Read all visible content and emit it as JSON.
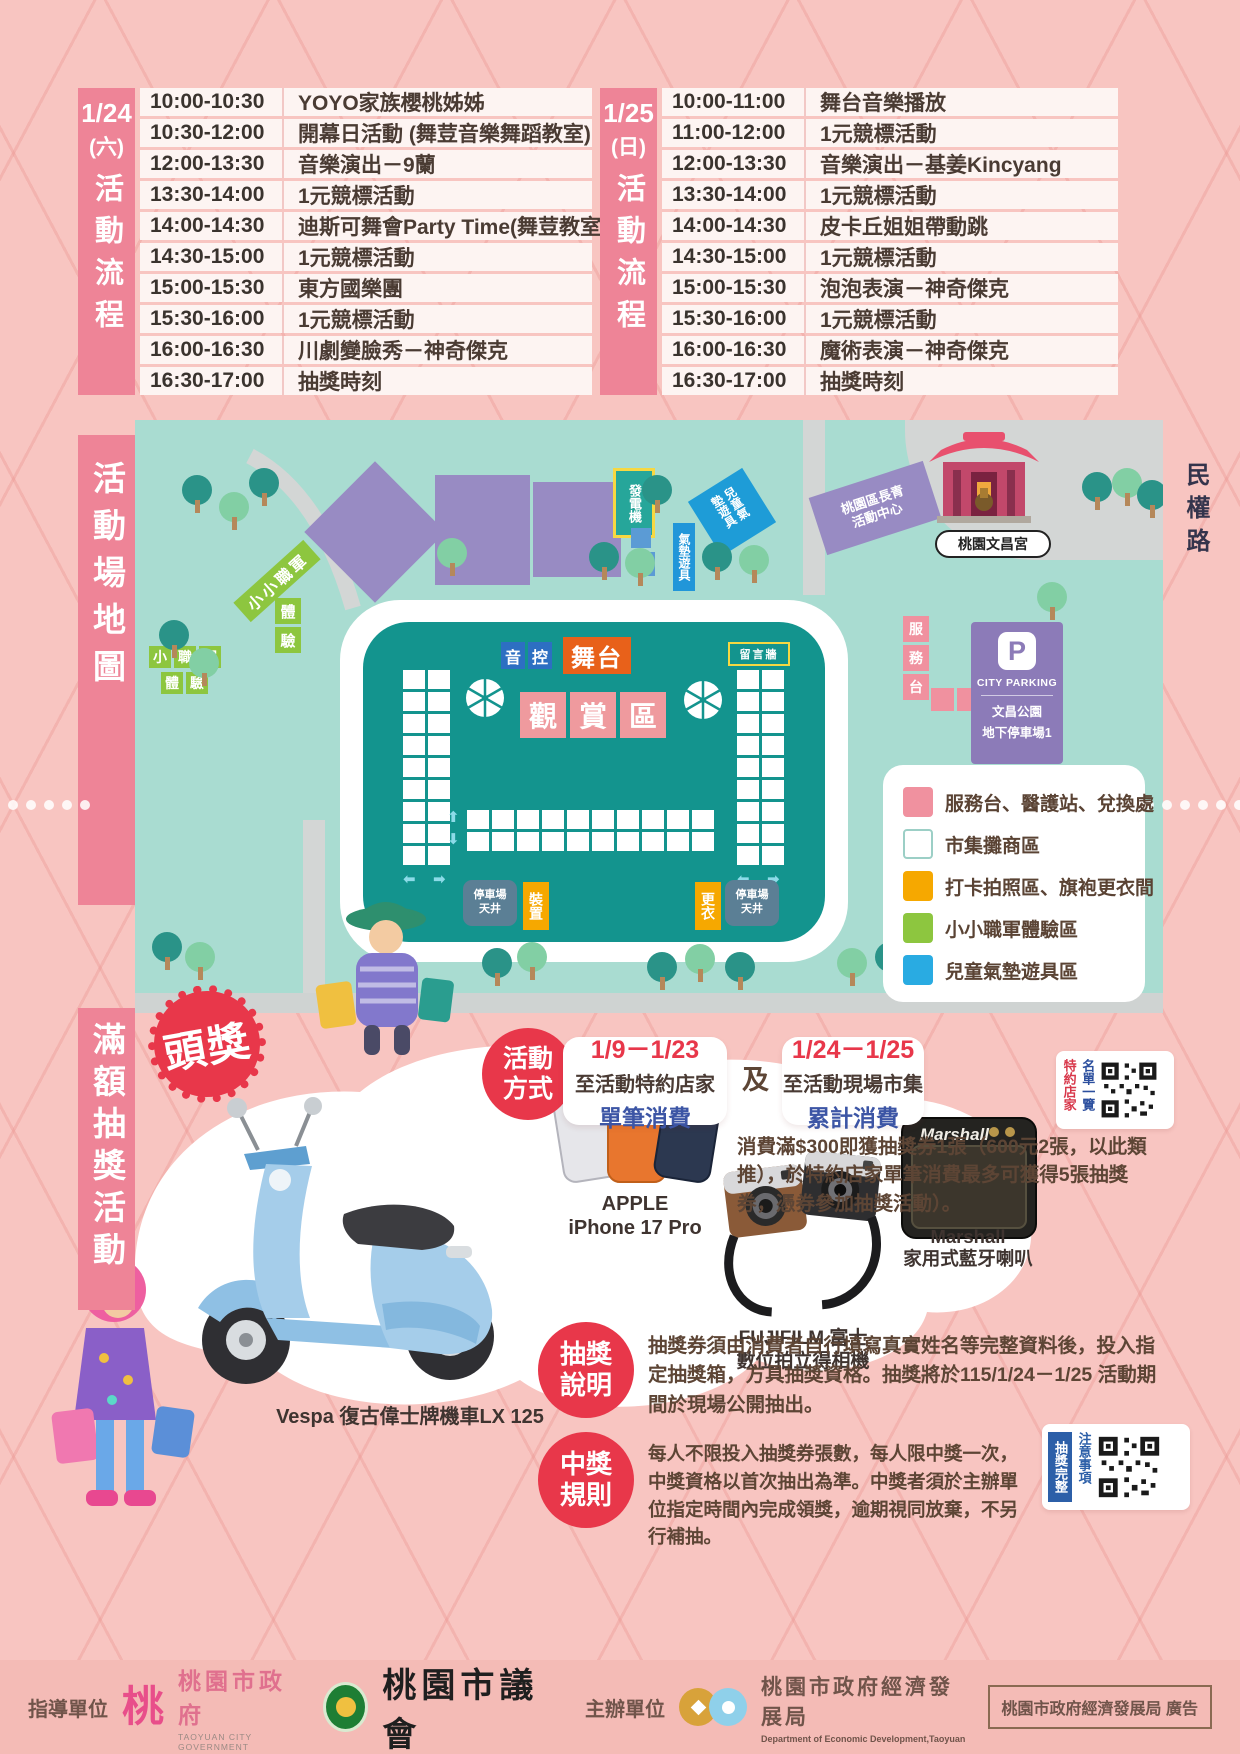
{
  "page": {
    "accent_red": "#e8374a",
    "accent_blue": "#3c55a5",
    "sidebar_pink": "#ee8497",
    "market_teal": "#13948e"
  },
  "schedule": {
    "left": {
      "date": "1/24",
      "day": "(六)",
      "title": "活動流程",
      "rows": [
        {
          "time": "10:00-10:30",
          "activity": "YOYO家族櫻桃姊姊"
        },
        {
          "time": "10:30-12:00",
          "activity": "開幕日活動 (舞荳音樂舞蹈教室)"
        },
        {
          "time": "12:00-13:30",
          "activity": "音樂演出－9蘭"
        },
        {
          "time": "13:30-14:00",
          "activity": "1元競標活動"
        },
        {
          "time": "14:00-14:30",
          "activity": "迪斯可舞會Party Time(舞荳教室)"
        },
        {
          "time": "14:30-15:00",
          "activity": "1元競標活動"
        },
        {
          "time": "15:00-15:30",
          "activity": "東方國樂團"
        },
        {
          "time": "15:30-16:00",
          "activity": "1元競標活動"
        },
        {
          "time": "16:00-16:30",
          "activity": "川劇變臉秀－神奇傑克"
        },
        {
          "time": "16:30-17:00",
          "activity": "抽獎時刻"
        }
      ]
    },
    "right": {
      "date": "1/25",
      "day": "(日)",
      "title": "活動流程",
      "rows": [
        {
          "time": "10:00-11:00",
          "activity": "舞台音樂播放"
        },
        {
          "time": "11:00-12:00",
          "activity": "1元競標活動"
        },
        {
          "time": "12:00-13:30",
          "activity": "音樂演出－基姜Kincyang"
        },
        {
          "time": "13:30-14:00",
          "activity": "1元競標活動"
        },
        {
          "time": "14:00-14:30",
          "activity": "皮卡丘姐姐帶動跳"
        },
        {
          "time": "14:30-15:00",
          "activity": "1元競標活動"
        },
        {
          "time": "15:00-15:30",
          "activity": "泡泡表演－神奇傑克"
        },
        {
          "time": "15:30-16:00",
          "activity": "1元競標活動"
        },
        {
          "time": "16:00-16:30",
          "activity": "魔術表演－神奇傑克"
        },
        {
          "time": "16:30-17:00",
          "activity": "抽獎時刻"
        }
      ]
    }
  },
  "map": {
    "sidebar_title": "活動場地圖",
    "road_name": "民權路",
    "labels": {
      "generator": "發電機",
      "kids_air_zone": "兒童氣墊遊具",
      "air_equipment": "氣墊遊具",
      "senior_center": "桃園區長青活動中心",
      "temple": "桃園文昌宮",
      "parking_p": "P",
      "parking_title": "CITY PARKING",
      "parking_sub1": "文昌公園",
      "parking_sub2": "地下停車場1",
      "junior_corps": "小小職軍",
      "stage": "舞台",
      "message_wall": "留言牆",
      "patio_line1": "停車場",
      "patio_line2": "天井",
      "install": "裝置",
      "changing": "更衣"
    },
    "viewing_chars": [
      "觀",
      "賞",
      "區"
    ],
    "service_chars": [
      "服",
      "務",
      "台"
    ],
    "sound_chars": [
      "音",
      "控"
    ],
    "exp_chars": [
      "體",
      "驗"
    ],
    "junior_chars": [
      "小",
      "職",
      "軍"
    ],
    "legend": {
      "items": [
        {
          "color": "#f0919f",
          "label": "服務台、醫護站、兌換處"
        },
        {
          "color": "#ffffff",
          "label": "市集攤商區"
        },
        {
          "color": "#f6a800",
          "label": "打卡拍照區、旗袍更衣間"
        },
        {
          "color": "#8dc63f",
          "label": "小小職軍體驗區"
        },
        {
          "color": "#29abe2",
          "label": "兒童氣墊遊具區"
        }
      ]
    }
  },
  "promo": {
    "sidebar_title": "滿額抽獎活動",
    "grand_prize": "頭獎",
    "method_badge": "活動方式",
    "and_text": "及",
    "cards": [
      {
        "date": "1/9－1/23",
        "line1": "至活動特約店家",
        "line2": "單筆消費"
      },
      {
        "date": "1/24－1/25",
        "line1": "至活動現場市集",
        "line2": "累計消費"
      }
    ],
    "qr_partners": {
      "col_red": "特約店家",
      "col_blue": "名單一覽"
    },
    "note": "消費滿$300即獲抽獎券1張（600元2張，以此類推），於特約店家單筆消費最多可獲得5張抽獎券，憑券參加抽獎活動）。",
    "prizes": {
      "vespa": "Vespa 復古偉士牌機車LX 125",
      "iphone_brand": "APPLE",
      "iphone_model": "iPhone 17 Pro",
      "fuji_brand": "FUJIFILM 富士",
      "fuji_model": "數位拍立得相機",
      "marshall_brand": "Marshall",
      "marshall_model": "家用式藍牙喇叭",
      "marshall_logo": "Marshall"
    },
    "draw_badge": "抽獎說明",
    "draw_text": "抽獎券須由消費者自行填寫真實姓名等完整資料後，投入指定抽獎箱，方具抽獎資格。抽獎將於115/1/24－1/25 活動期間於現場公開抽出。",
    "win_badge": "中獎規則",
    "win_text": "每人不限投入抽獎券張數，每人限中獎一次，中獎資格以首次抽出為準。中獎者須於主辦單位指定時間內完成領獎，逾期視同放棄，不另行補抽。",
    "qr_rules": {
      "col_white": "抽獎完整",
      "col_blue": "注意事項"
    }
  },
  "footer": {
    "guide_label": "指導單位",
    "gov_logo_char": "桃",
    "gov_name": "桃園市政府",
    "gov_en": "TAOYUAN CITY GOVERNMENT",
    "council_name": "桃園市議會",
    "host_label": "主辦單位",
    "econ_name": "桃園市政府經濟發展局",
    "econ_en": "Department of Economic Development,Taoyuan",
    "ad_note": "桃園市政府經濟發展局 廣告"
  }
}
